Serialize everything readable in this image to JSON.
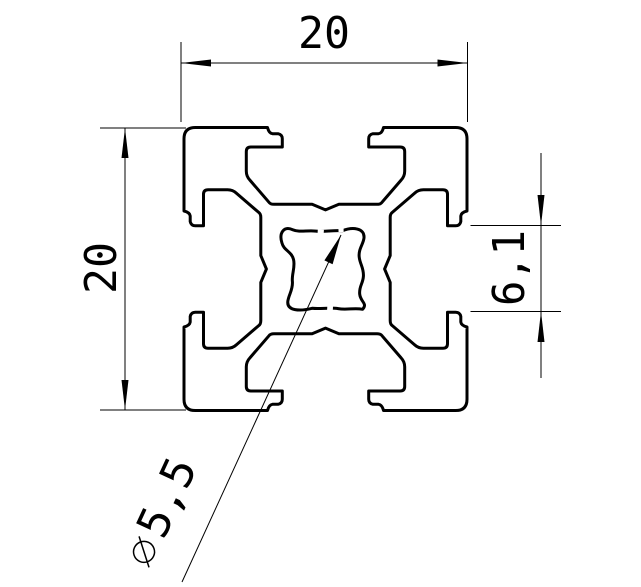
{
  "drawing": {
    "background": "#ffffff",
    "line_color": "#000000",
    "dimensions": {
      "top_width": {
        "label": "20"
      },
      "left_height": {
        "label": "20"
      },
      "slot_opening": {
        "label": "6,1"
      },
      "center_bore": {
        "label": "⌀5,5",
        "symbol": "diameter-symbol",
        "value_label": "5,5"
      }
    }
  }
}
